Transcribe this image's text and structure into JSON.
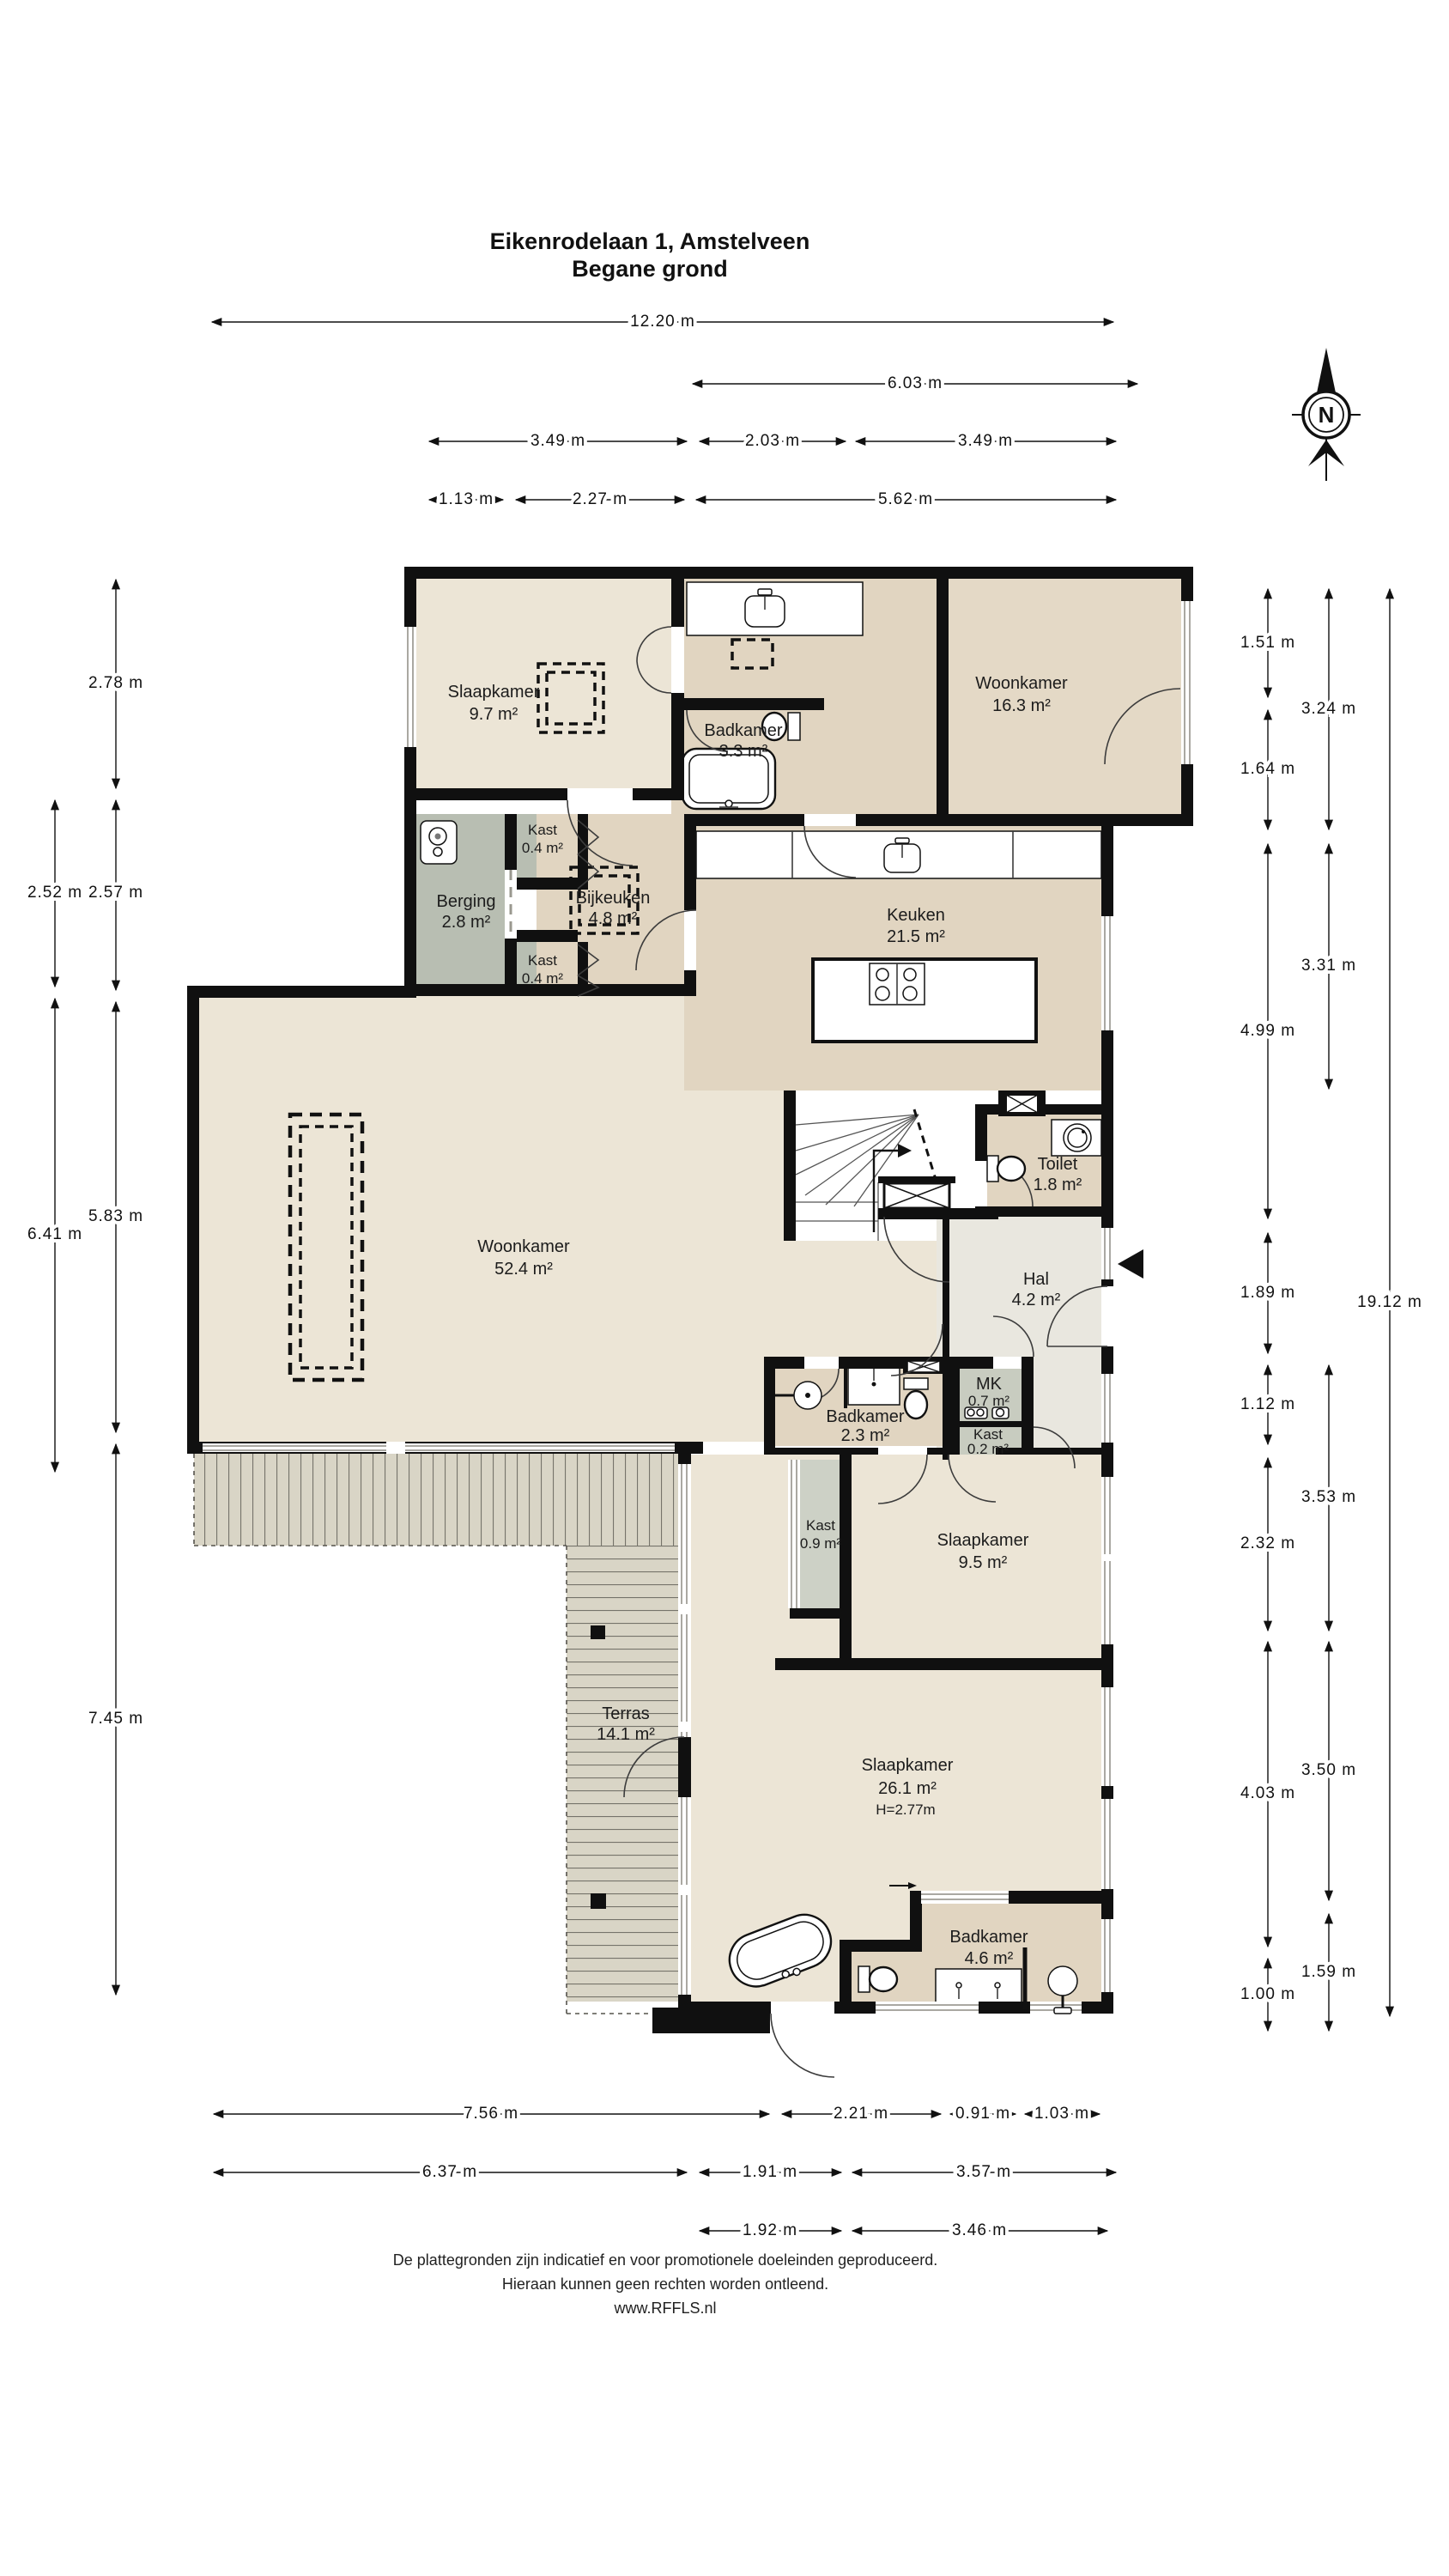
{
  "title": {
    "line1": "Eikenrodelaan 1, Amstelveen",
    "line2": "Begane grond"
  },
  "compass": {
    "north_label": "N"
  },
  "rooms": {
    "slaapkamer1": {
      "name": "Slaapkamer",
      "area": "9.7 m²"
    },
    "badkamer1": {
      "name": "Badkamer",
      "area": "3.3 m²"
    },
    "woonkamer1": {
      "name": "Woonkamer",
      "area": "16.3 m²"
    },
    "kast1": {
      "name": "Kast",
      "area": "0.4 m²"
    },
    "berging": {
      "name": "Berging",
      "area": "2.8 m²"
    },
    "bijkeuken": {
      "name": "Bijkeuken",
      "area": "4.8 m²"
    },
    "kast2": {
      "name": "Kast",
      "area": "0.4 m²"
    },
    "keuken": {
      "name": "Keuken",
      "area": "21.5 m²"
    },
    "woonkamer2": {
      "name": "Woonkamer",
      "area": "52.4 m²"
    },
    "toilet": {
      "name": "Toilet",
      "area": "1.8 m²"
    },
    "hal": {
      "name": "Hal",
      "area": "4.2 m²"
    },
    "badkamer2": {
      "name": "Badkamer",
      "area": "2.3 m²"
    },
    "mk": {
      "name": "MK",
      "area": "0.7 m²"
    },
    "kast3": {
      "name": "Kast",
      "area": "0.2 m²"
    },
    "kast4": {
      "name": "Kast",
      "area": "0.9 m²"
    },
    "slaapkamer2": {
      "name": "Slaapkamer",
      "area": "9.5 m²"
    },
    "terras": {
      "name": "Terras",
      "area": "14.1 m²"
    },
    "slaapkamer3": {
      "name": "Slaapkamer",
      "area": "26.1 m²",
      "height": "H=2.77m"
    },
    "badkamer3": {
      "name": "Badkamer",
      "area": "4.6 m²"
    }
  },
  "dimensions": {
    "top": [
      "12.20 m",
      "6.03 m",
      "3.49 m",
      "2.03 m",
      "3.49 m",
      "1.13 m",
      "2.27 m",
      "5.62 m"
    ],
    "bottom": [
      "7.56 m",
      "2.21 m",
      "0.91 m",
      "1.03 m",
      "6.37 m",
      "1.91 m",
      "3.57 m",
      "1.92 m",
      "3.46 m"
    ],
    "left": [
      "2.78 m",
      "2.52 m",
      "2.57 m",
      "6.41 m",
      "5.83 m",
      "7.45 m"
    ],
    "right": [
      "1.51 m",
      "1.64 m",
      "4.99 m",
      "1.89 m",
      "1.12 m",
      "2.32 m",
      "4.03 m",
      "1.00 m",
      "3.24 m",
      "3.31 m",
      "3.53 m",
      "3.50 m",
      "1.59 m",
      "19.12 m"
    ]
  },
  "footer": {
    "line1": "De plattegronden zijn indicatief en voor promotionele doeleinden geproduceerd.",
    "line2": "Hieraan kunnen geen rechten worden ontleend.",
    "line3": "www.RFFLS.nl"
  },
  "colors": {
    "wall": "#101010",
    "room_beige": "#ece5d6",
    "room_tan": "#e1d5c1",
    "room_gray_green": "#b8beb2",
    "room_gray": "#c8ccc0",
    "room_hal": "#e9e7df",
    "deck": "#d9d5c6",
    "background": "#ffffff"
  }
}
